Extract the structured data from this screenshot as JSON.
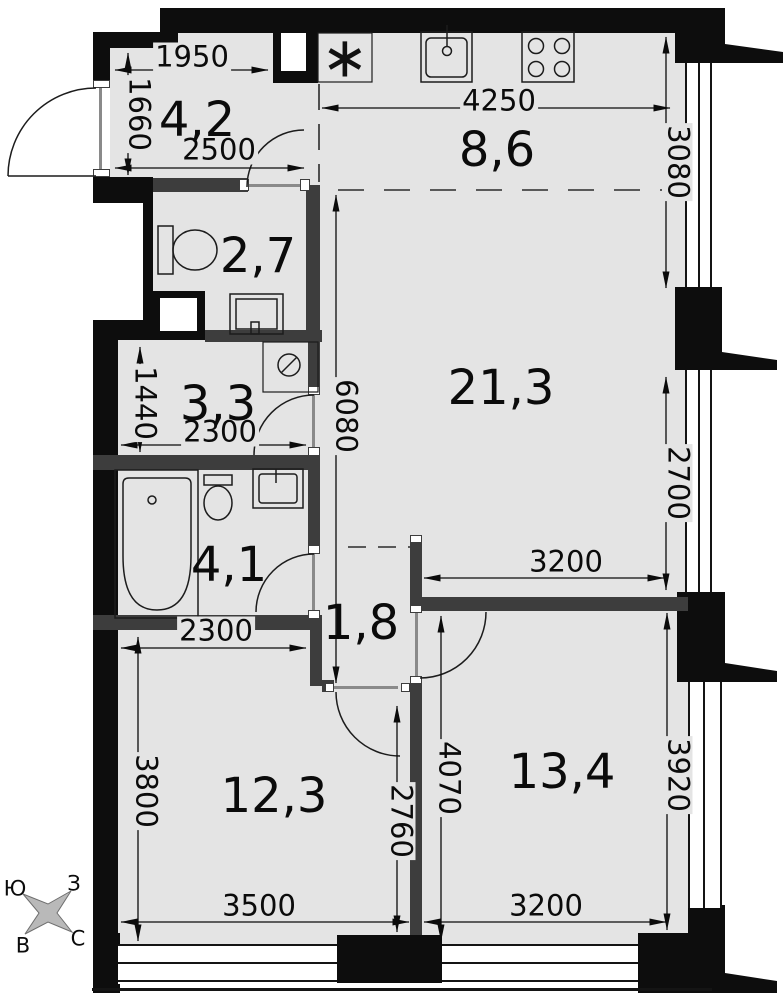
{
  "rooms": [
    {
      "name": "hallway",
      "area": "4,2"
    },
    {
      "name": "kitchen-zone",
      "area": "8,6"
    },
    {
      "name": "wc",
      "area": "2,7"
    },
    {
      "name": "living-room",
      "area": "21,3"
    },
    {
      "name": "dressing-hall",
      "area": "3,3"
    },
    {
      "name": "bathroom",
      "area": "4,1"
    },
    {
      "name": "corridor",
      "area": "1,8"
    },
    {
      "name": "bedroom",
      "area": "12,3"
    },
    {
      "name": "bedroom-2",
      "area": "13,4"
    }
  ],
  "dims": [
    {
      "id": "hall-top-width",
      "value": "1950"
    },
    {
      "id": "hall-left-depth",
      "value": "1660"
    },
    {
      "id": "hall-bottom-width",
      "value": "2500"
    },
    {
      "id": "kitchen-width",
      "value": "4250"
    },
    {
      "id": "kitchen-depth",
      "value": "3080"
    },
    {
      "id": "living-right-depth",
      "value": "2700"
    },
    {
      "id": "living-bottom-width",
      "value": "3200"
    },
    {
      "id": "living-total-length",
      "value": "6080"
    },
    {
      "id": "dressing-depth",
      "value": "1440"
    },
    {
      "id": "dressing-width",
      "value": "2300"
    },
    {
      "id": "bedroom-top-width",
      "value": "2300"
    },
    {
      "id": "bedroom-left-depth",
      "value": "3800"
    },
    {
      "id": "partition-length",
      "value": "2760"
    },
    {
      "id": "room2-left-depth",
      "value": "4070"
    },
    {
      "id": "room2-right-depth",
      "value": "3920"
    },
    {
      "id": "bedroom-bottom-width",
      "value": "3500"
    },
    {
      "id": "room2-bottom-width",
      "value": "3200"
    }
  ],
  "compass": {
    "nw": "Ю",
    "ne": "З",
    "sw": "В",
    "se": "С"
  },
  "symbols": {
    "appliance_marker": "∗"
  },
  "colors": {
    "floor": "#e4e4e4",
    "exterior_wall": "#0d0d0d",
    "interior_wall": "#3d3d3d"
  }
}
